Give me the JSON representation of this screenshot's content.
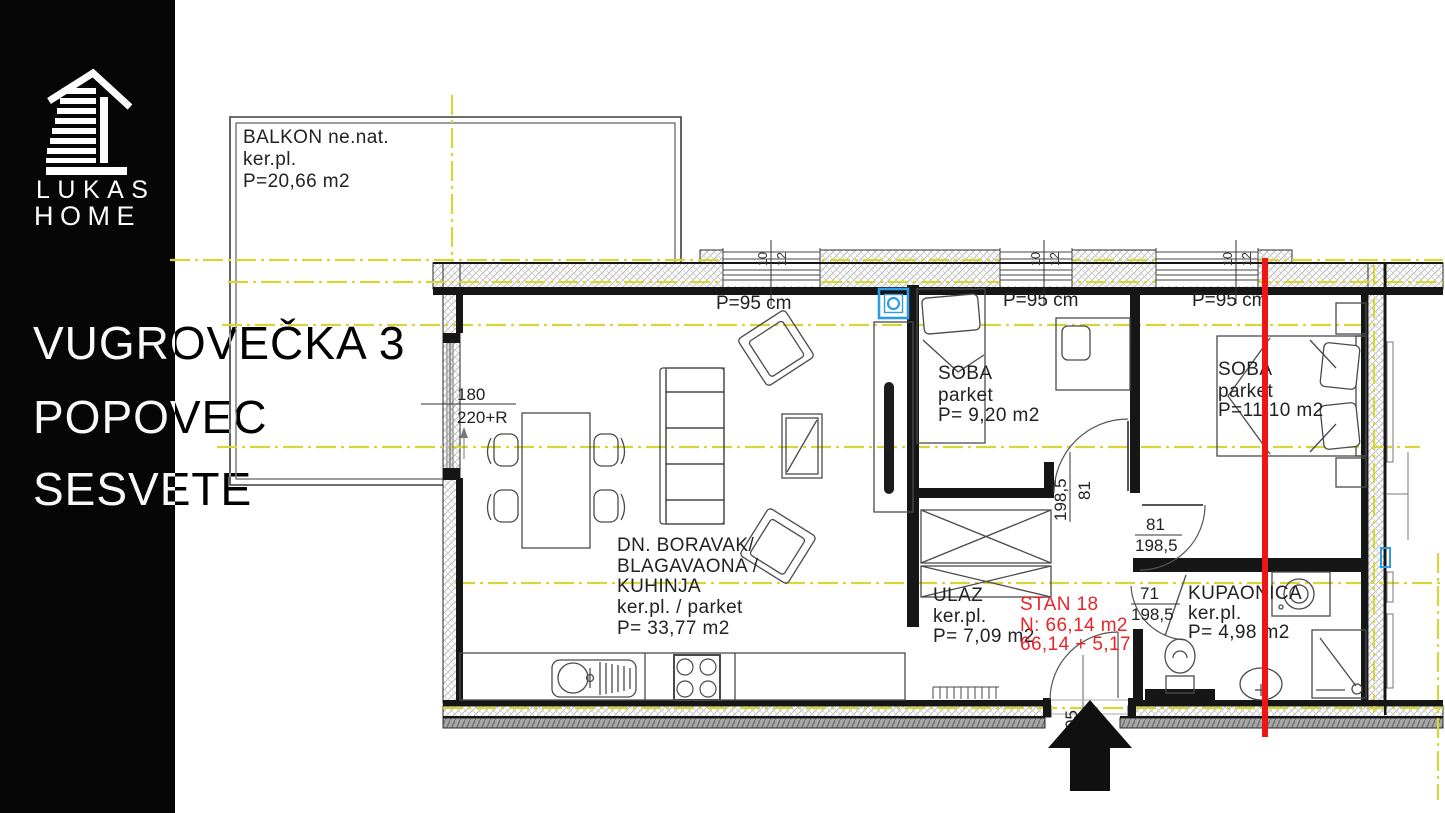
{
  "brand": {
    "logo_line1": "LUKAS",
    "logo_line2": "HOME"
  },
  "project": {
    "address_lines": [
      "VUGROVEČKA 3",
      "POPOVEC",
      "SESVETE"
    ]
  },
  "rooms": {
    "balcony": {
      "lines": [
        "BALKON ne.nat.",
        "ker.pl.",
        "P=20,66 m2"
      ]
    },
    "living": {
      "lines": [
        "DN. BORAVAK/",
        "BLAGAVAONA /",
        "KUHINJA",
        "ker.pl. / parket",
        "P= 33,77 m2"
      ]
    },
    "bedroom1": {
      "lines": [
        "SOBA",
        "parket",
        "P= 9,20 m2"
      ]
    },
    "bedroom2": {
      "lines": [
        "SOBA",
        "parket",
        "P=11,10 m2"
      ]
    },
    "hall": {
      "lines": [
        "ULAZ",
        "ker.pl.",
        "P= 7,09 m2"
      ]
    },
    "bathroom": {
      "lines": [
        "KUPAONICA",
        "ker.pl.",
        "P= 4,98 m2"
      ]
    }
  },
  "unit": {
    "lines": [
      "STAN 18",
      "N: 66,14 m2",
      "66,14 + 5,17"
    ]
  },
  "windows": {
    "sill_label": "P=95 cm",
    "mini_labels": [
      "10",
      "12"
    ]
  },
  "dimensions": {
    "balcony_door": {
      "width": "180",
      "height": "220+R"
    },
    "bedroom1_door": {
      "width": "81",
      "height": "198,5"
    },
    "bedroom2_door": {
      "width": "81",
      "height": "198,5"
    },
    "bathroom_door": {
      "width": "71",
      "height": "198,5"
    },
    "entrance_door": {
      "width": "05"
    }
  },
  "colors": {
    "axis": "#d6d63a",
    "marker_line": "#ee1515",
    "boiler": "#2e9ce4",
    "window_label": "#ff87f0",
    "unit_label": "#e8252a"
  }
}
